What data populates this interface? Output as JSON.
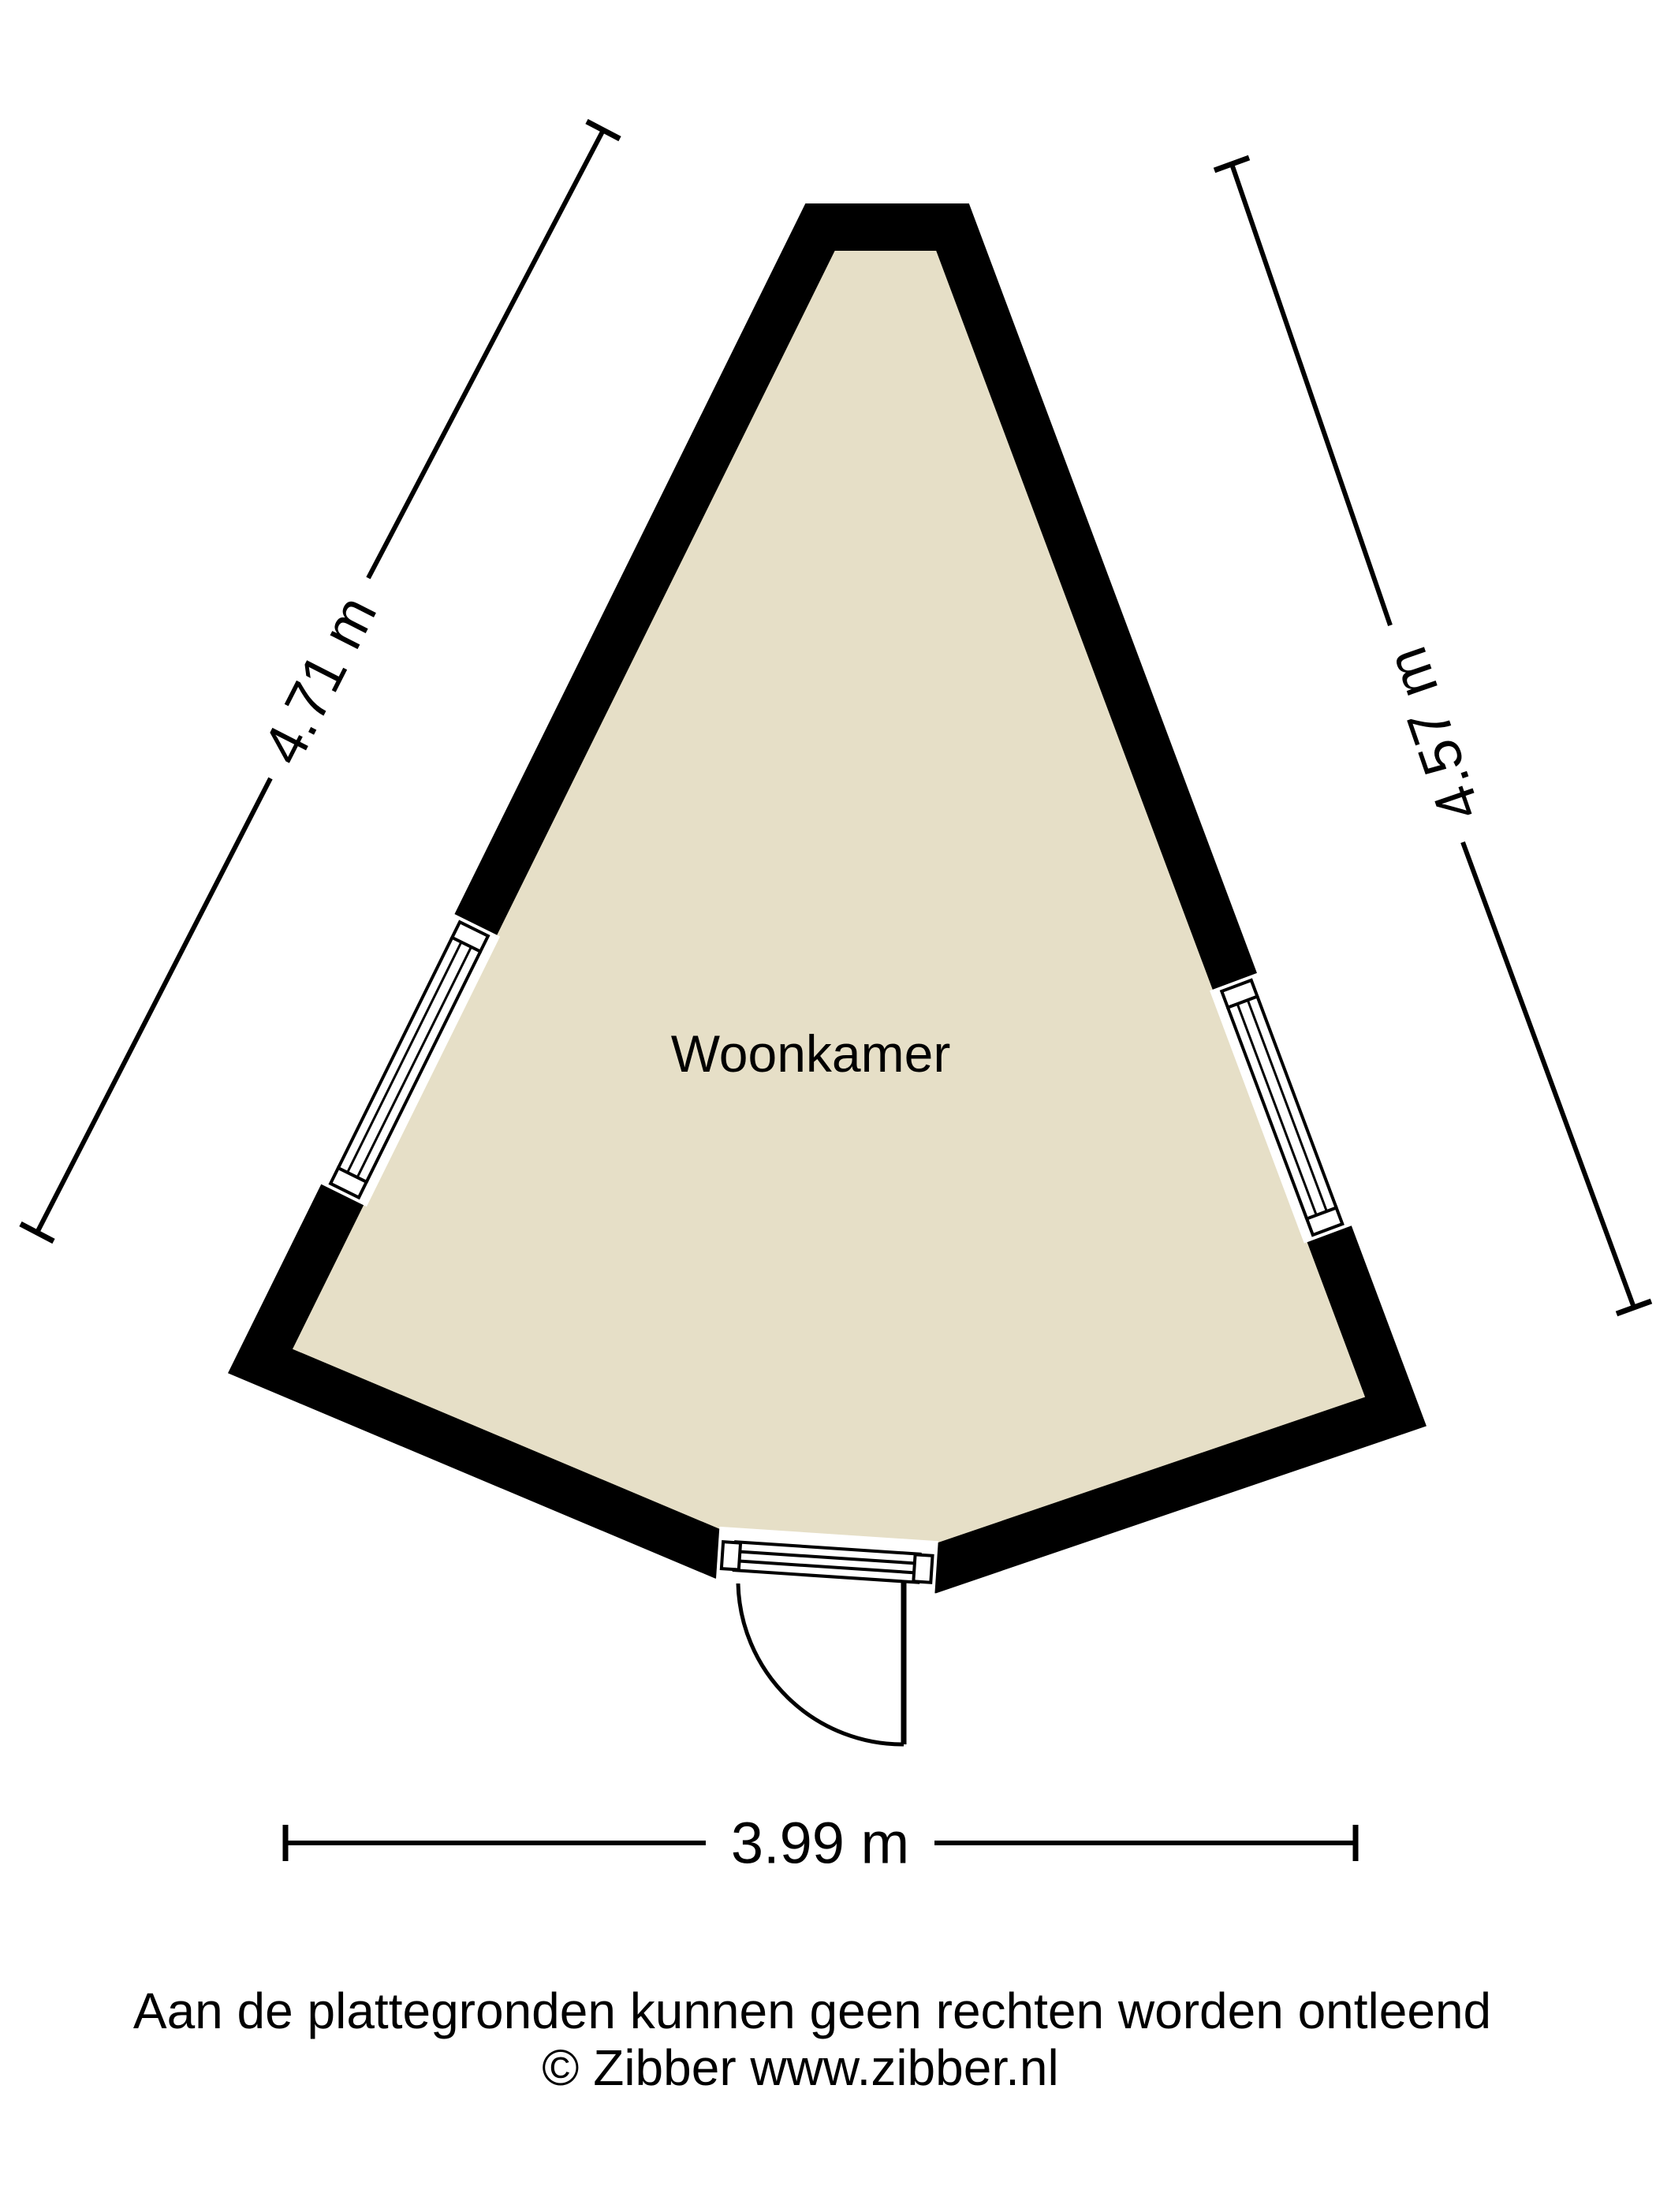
{
  "plan": {
    "room_label": "Woonkamer",
    "dim_left": "4.71 m",
    "dim_right": "4.57 m",
    "dim_bottom": "3.99 m"
  },
  "footer": {
    "disclaimer": "Aan de plattegronden kunnen geen rechten worden ontleend",
    "credit": "© Zibber www.zibber.nl"
  },
  "colors": {
    "floor": "#e6dfc7",
    "wall": "#000000",
    "dimension_line": "#000000",
    "background": "#ffffff"
  }
}
